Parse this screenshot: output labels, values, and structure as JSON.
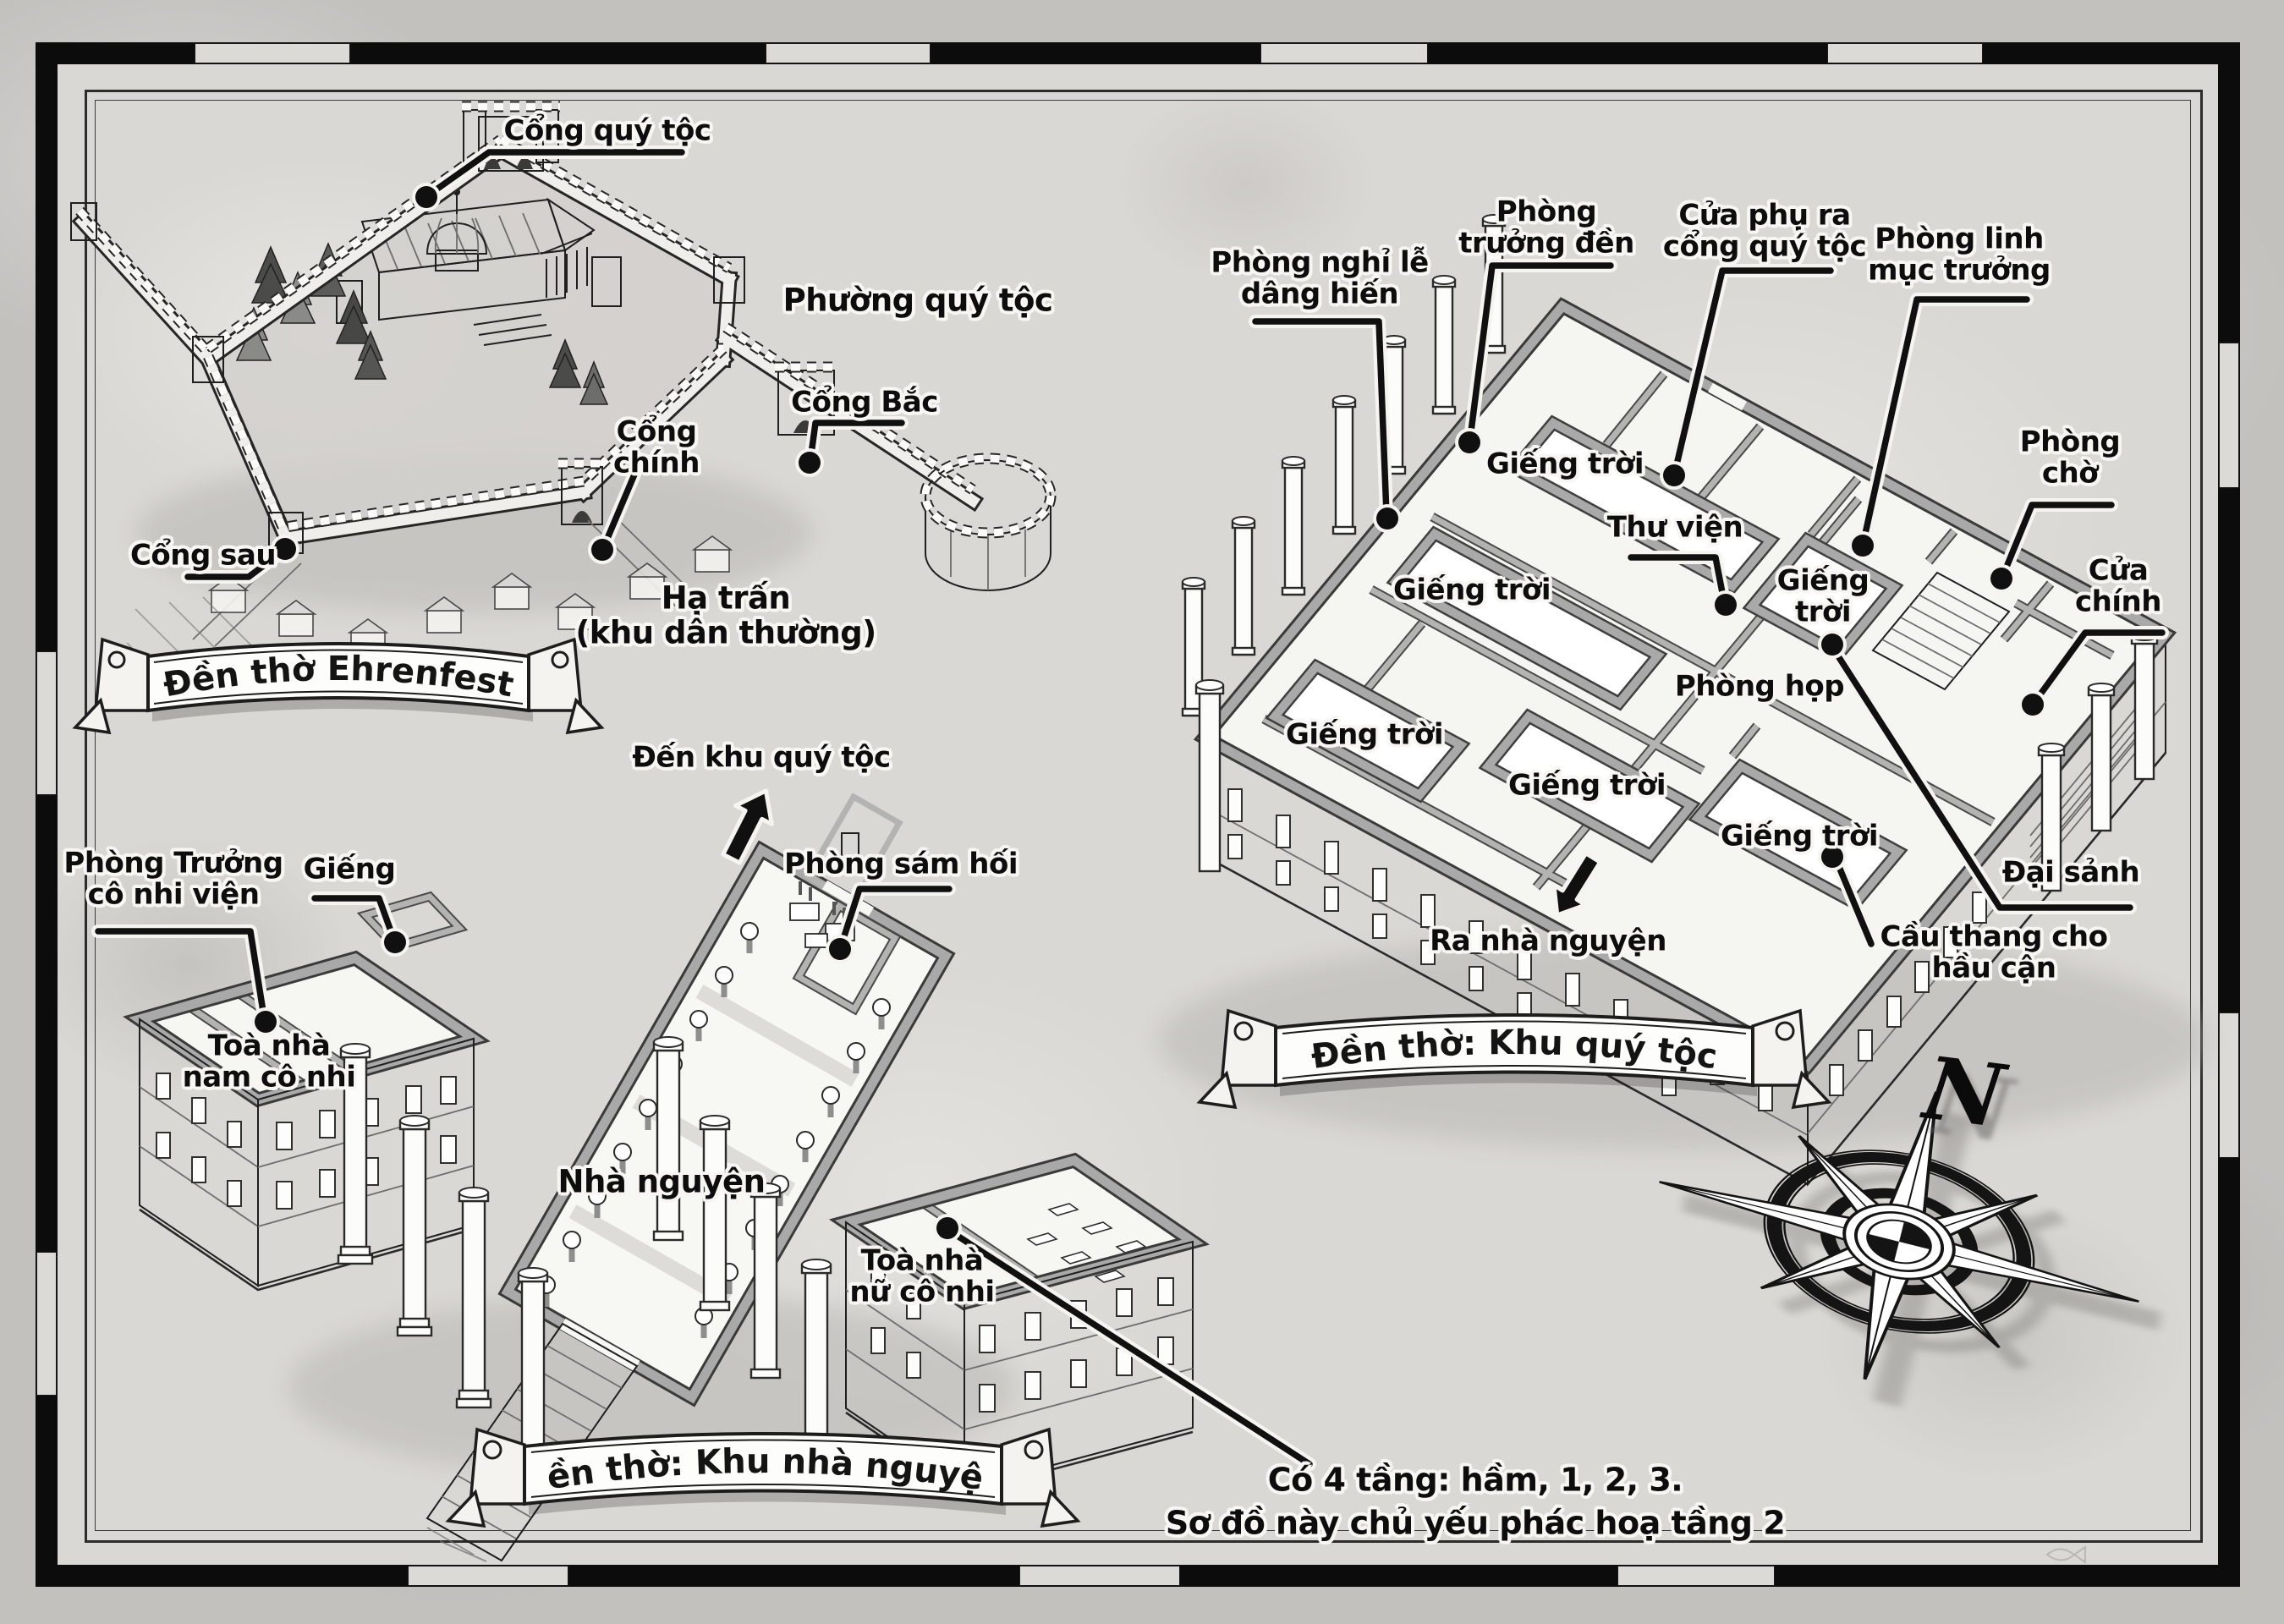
{
  "map": {
    "region_labels": {
      "phuong_quy_toc": "Phường quý tộc",
      "ha_tran": "Hạ trấn\n(khu dân thường)"
    },
    "ehrenfest": {
      "banner": "Đền thờ Ehrenfest",
      "cong_quy_toc": "Cổng quý tộc",
      "cong_bac": "Cổng Bắc",
      "cong_chinh": "Cổng\nchính",
      "cong_sau": "Cổng sau"
    },
    "noble_quarter": {
      "banner": "Đền thờ: Khu quý tộc",
      "phong_nghi_le": "Phòng nghỉ lễ\ndâng hiến",
      "phong_truong_den": "Phòng\ntrưởng đền",
      "cua_phu": "Cửa phụ ra\ncổng quý tộc",
      "phong_linh_muc": "Phòng linh\nmục trưởng",
      "phong_cho": "Phòng\nchờ",
      "cua_chinh": "Cửa\nchính",
      "gieng_troi": "Giếng trời",
      "gieng_troi_stacked": "Giếng\ntrời",
      "thu_vien": "Thư viện",
      "phong_hop": "Phòng họp",
      "dai_sanh": "Đại sảnh",
      "ra_nha_nguyen": "Ra nhà nguyện",
      "cau_thang": "Cầu thang cho hầu cận"
    },
    "chapel": {
      "banner": "Đền thờ: Khu nhà nguyện",
      "den_khu_quy_toc": "Đến khu quý tộc",
      "phong_truong_co_nhi": "Phòng Trưởng\ncô nhi viện",
      "gieng": "Giếng",
      "phong_sam_hoi": "Phòng sám hối",
      "toa_nam": "Toà nhà\nnam cô nhi",
      "nha_nguyen": "Nhà nguyện",
      "toa_nu": "Toà nhà\nnữ cô nhi"
    },
    "note": "Có 4 tầng: hầm, 1, 2, 3.\nSơ đồ này chủ yếu phác hoạ tầng 2",
    "compass": {
      "north": "N"
    },
    "colors": {
      "ink": "#1f1f1f",
      "paper": "#dad8d4",
      "wall_gray": "#a9a9a9"
    }
  }
}
